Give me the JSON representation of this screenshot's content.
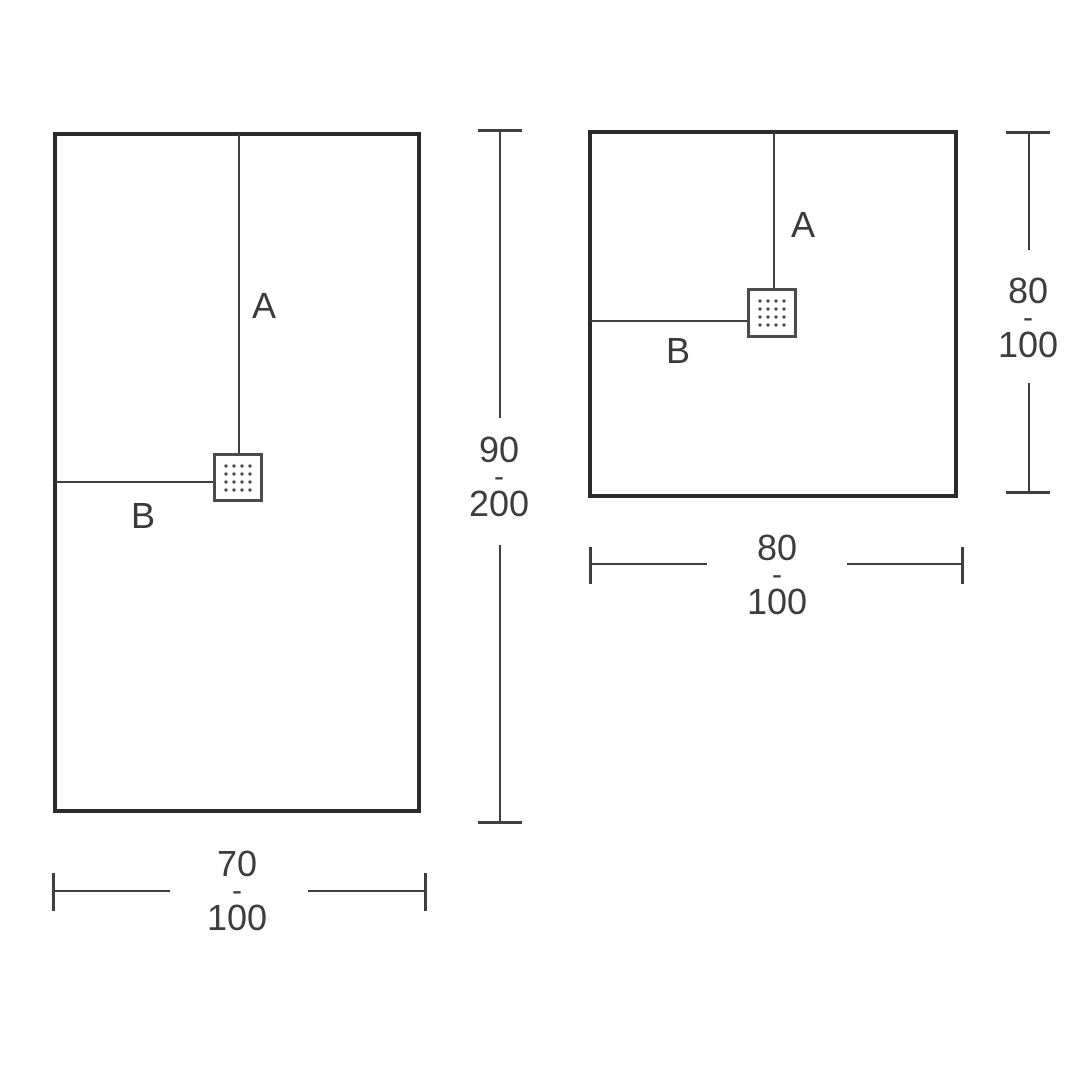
{
  "page": {
    "background_color": "#ffffff",
    "outline_color": "#2b2b2b",
    "line_color": "#3f3f3f",
    "text_color": "#3d3d3d"
  },
  "figures": [
    {
      "id": "rectangular-shower-tray",
      "drain_label_vertical": "A",
      "drain_label_horizontal": "B",
      "height_range": {
        "min": "90",
        "separator": "-",
        "max": "200"
      },
      "width_range": {
        "min": "70",
        "separator": "-",
        "max": "100"
      }
    },
    {
      "id": "square-shower-tray",
      "drain_label_vertical": "A",
      "drain_label_horizontal": "B",
      "height_range": {
        "min": "80",
        "separator": "-",
        "max": "100"
      },
      "width_range": {
        "min": "80",
        "separator": "-",
        "max": "100"
      }
    }
  ]
}
